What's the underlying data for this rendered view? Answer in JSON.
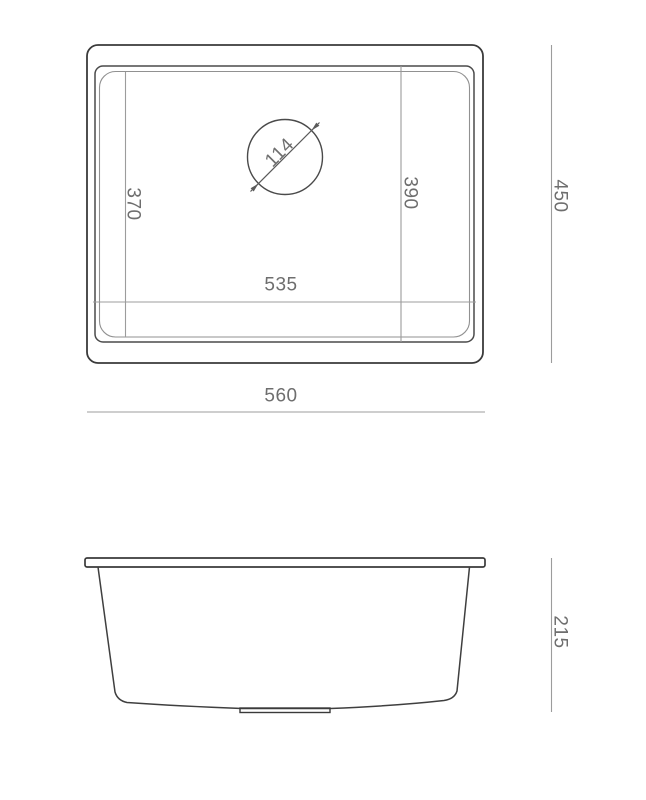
{
  "colors": {
    "background": "#ffffff",
    "outline_dark": "#3a3a3a",
    "outline_mid": "#4a4a4a",
    "outline_light": "#919191",
    "dim_line": "#9c9c9c",
    "dim_text": "#6e6e6e"
  },
  "top_view": {
    "dims": {
      "overall_width": "560",
      "overall_depth": "450",
      "bowl_width": "535",
      "bowl_depth_right": "390",
      "bowl_depth_left": "370",
      "drain_diameter": "114"
    }
  },
  "side_view": {
    "dims": {
      "overall_height": "215"
    }
  }
}
